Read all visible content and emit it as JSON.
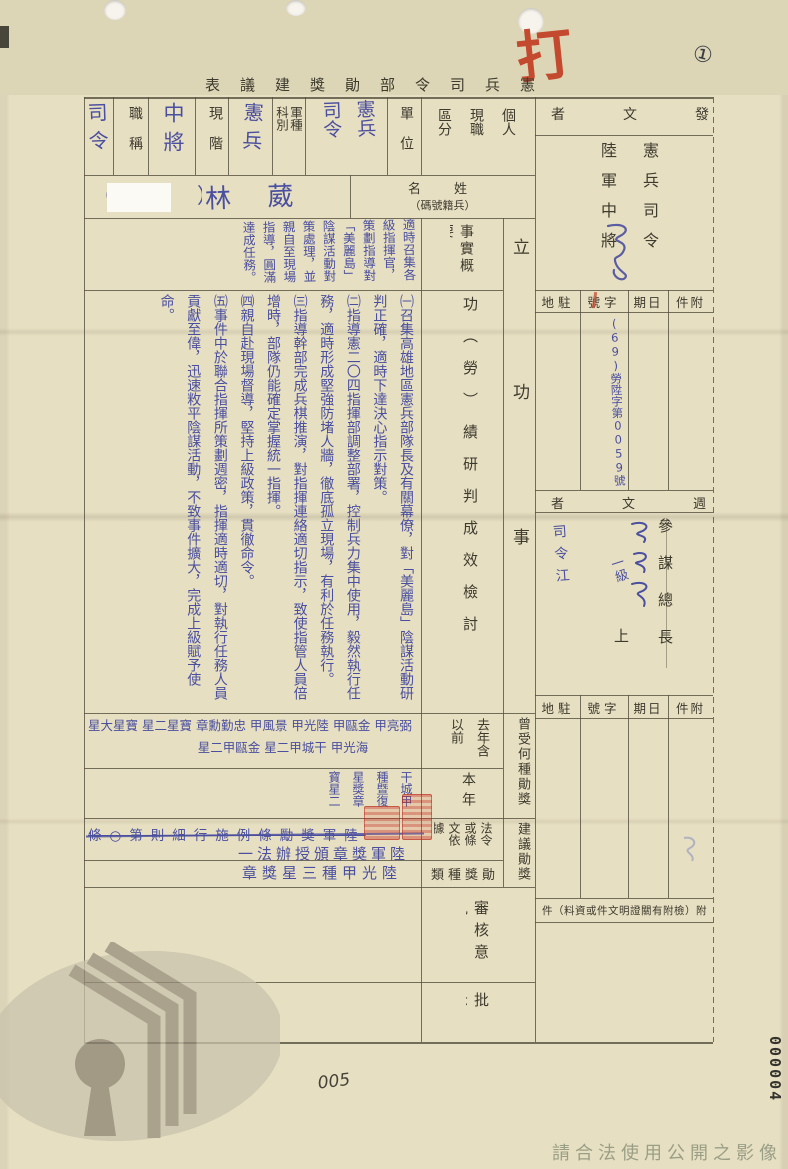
{
  "meta": {
    "circled_number": "①",
    "red_mark": "打",
    "page_number": "005",
    "archive_number": "000004",
    "copyright_notice": "請合法使用公開之影像",
    "colors": {
      "paper": "#e7dfc2",
      "handwriting_blue": "#4a4f9f",
      "stamp_red": "#c44a2f",
      "print_ink": "#3d3a2e"
    }
  },
  "title": {
    "displayed": "表議建獎勛部令司兵憲"
  },
  "header": {
    "duty_value": "司令",
    "duty_label": "職稱",
    "rank_value": "中將",
    "rank_label": "現階",
    "branch_value": "憲兵",
    "branch_label": "軍種科別",
    "unit_value": "憲兵司令部",
    "unit_label": "單位",
    "status_label": "個人現職區分"
  },
  "name": {
    "paren": "（　　　　）",
    "value": "林 葳 史",
    "label_line1": "名　姓",
    "label_line2": "（碼號籍兵）"
  },
  "sections": {
    "ligong": "立功事蹟",
    "fact_label": "事實概要",
    "fact_text": "適時召集各級指揮官，策劃指導對「美麗島」陰謀活動對策處理，並親自至現場指導，圓滿達成任務。",
    "merit_label": "功（勞）績研判成效檢討",
    "merit_text": "㈠召集高雄地區憲兵部隊長及有關幕僚，對「美麗島」陰謀活動研判正確，適時下達決心指示對策。\n㈡指導憲二〇四指揮部調整部署，控制兵力集中使用，毅然執行任務，適時形成堅強防堵人牆，徹底孤立現場，有利於任務執行。\n㈢指導幹部完成兵棋推演，對指揮連絡適切指示，致使指管人員倍增時，部隊仍能確定掌握統一指揮。\n㈣親自赴現場督導，堅持上級政策，貫徹命令。\n㈤事件中於聯合指揮所策劃週密，指揮適時適切，對執行任務人員貢獻至偉，迅速敉平陰謀活動，不致事件擴大，完成上級賦予使命。",
    "awards_label": "曾受何種勛獎",
    "prev_label": "去年含以前",
    "prev_line1": "星大星寶 星二星寶 章勳勤忠 甲風景 甲光陸 甲甌金 甲亮弼",
    "prev_line2": "星二甲甌金 星二甲城干 甲光海",
    "year_label": "本年",
    "year_text": "干城甲種暨復星獎章寶星二星",
    "proposal_label": "建議勛獎",
    "legal_label": "法令或條文依據",
    "legal_struck": "條○第則細行施例條勵獎軍陸",
    "legal_line2": "一法辦授頒章獎軍陸",
    "type_label": "類種獎勛",
    "type_text": "章獎星三種甲光陸",
    "review_label": "審核意見",
    "approve_label": "批示",
    "attachment_note": "件（料資或件文明證關有附檢）附"
  },
  "sender": {
    "header": "者文發",
    "body": "憲兵司令陸軍中將",
    "meta_labels": [
      "地駐",
      "號字",
      "期日",
      "件附"
    ],
    "ref_number": "(69)勞陞字第0059號"
  },
  "reviewer": {
    "header": "者文週",
    "title": "參謀總長",
    "rank": "上將",
    "hw_level": "一級",
    "hw_side": "司令江"
  }
}
